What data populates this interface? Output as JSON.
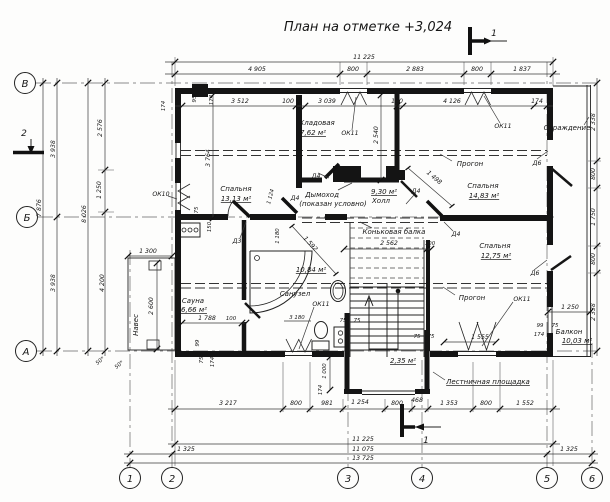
{
  "title": "План на отметке +3,024",
  "axes": {
    "row": [
      "В",
      "Б",
      "А"
    ],
    "col": [
      "1",
      "2",
      "3",
      "4",
      "5",
      "6"
    ]
  },
  "sections": {
    "s2": "2",
    "s1top": "1",
    "s1bottom": "1"
  },
  "rooms": {
    "bedroom1": {
      "name": "Спальня",
      "area": "13,13 м²"
    },
    "storage": {
      "name": "Кладовая",
      "area": "7,62 м²"
    },
    "hall": {
      "name": "Холл",
      "area": "9,30 м²"
    },
    "bedroom2": {
      "name": "Спальня",
      "area": "14,83 м²"
    },
    "bedroom3": {
      "name": "Спальня",
      "area": "12,75 м²"
    },
    "sauna": {
      "name": "Сауна",
      "area": "6,66 м²"
    },
    "bath": {
      "name": "Санузел",
      "area": "10,84 м²"
    },
    "balcony": {
      "name": "Балкон",
      "area": "10,03 м²"
    },
    "landing": {
      "name": "Лестничная площадка",
      "area": "2,35 м²"
    },
    "canopy": {
      "name": "Навес"
    }
  },
  "callouts": {
    "girder": "Прогон",
    "ridge": "Коньковая балка",
    "chimney_line1": "Дымоход",
    "chimney_line2": "(показан условно)",
    "railing": "Ограждение"
  },
  "openings": {
    "ok10": "ОК10",
    "ok11": "ОК11",
    "d3": "Д3",
    "d4": "Д4",
    "d6": "Д6"
  },
  "dims": {
    "top_total": "11 225",
    "top": [
      "4 905",
      "800",
      "2 883",
      "800",
      "1 837"
    ],
    "sub": [
      "95",
      "174",
      "3 512",
      "100",
      "3 039",
      "100",
      "4 126",
      "174"
    ],
    "left_wall_174": "174",
    "left": [
      "3 938",
      "3 938",
      "7 876",
      "8 026"
    ],
    "left_inner": [
      "2 576",
      "1 250",
      "4 200"
    ],
    "right": [
      "2 338",
      "800",
      "1 750",
      "800",
      "2 338"
    ],
    "bottom": [
      "3 217",
      "800",
      "981",
      "1 254",
      "800",
      "468",
      "1 353",
      "800",
      "1 552"
    ],
    "totals": [
      "11 225",
      "11 075",
      "13 725"
    ],
    "side_1325": [
      "1 325",
      "1 325"
    ],
    "canopy_w": "1 300",
    "canopy_h": "2 600",
    "sauna_w": "1 788",
    "sauna_100": "100",
    "bed1_d": "3 764",
    "stor_d": "2 540",
    "door_1124": "1 124",
    "bath_1180": "1 180",
    "diag_1498": "1 498",
    "diag_1592": "1 592",
    "hall_2562": "2 562",
    "hall_100": "100",
    "bath_3180": "3 180",
    "win_1555": "1 555",
    "balc_1250": "1 250",
    "balc_99": "99",
    "balc_75": "75",
    "balc_174": "174",
    "bump_1000": "1 000",
    "bump_174": "174",
    "st75a": "75",
    "st75b": "75",
    "st75c": "75",
    "st75d": "75",
    "sw_99": "99",
    "sw_75": "75",
    "sw_174": "174",
    "nw_75": "75",
    "nw_150": "150",
    "off50a": "50*",
    "off50b": "50*"
  }
}
